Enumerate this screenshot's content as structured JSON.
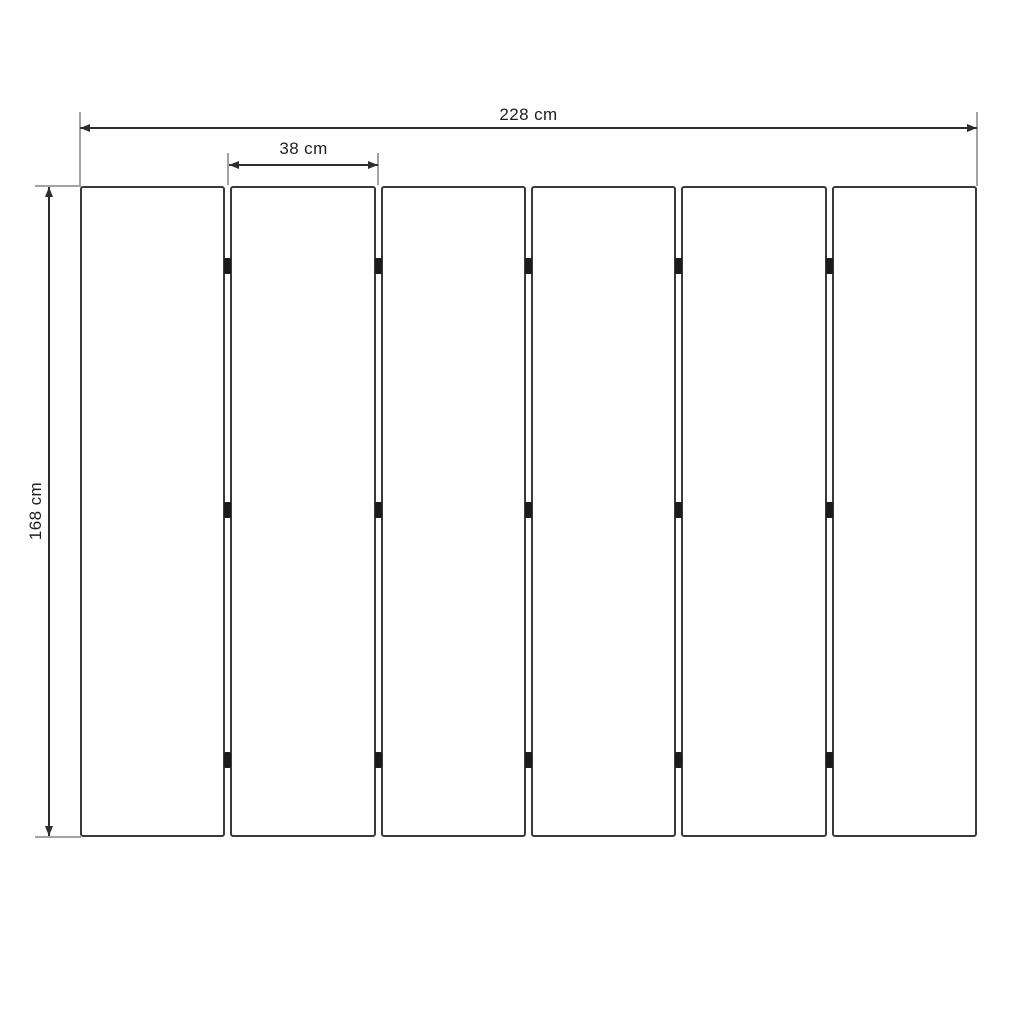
{
  "diagram": {
    "kind": "panel-wall-dimension-drawing",
    "colors": {
      "panel_border": "#3a3a3a",
      "dimension_line": "#2d2d2d",
      "extension_line": "#a3a3a3",
      "hinge": "#1b1b1b",
      "text": "#1f1f1f",
      "background": "#ffffff"
    },
    "panels": {
      "count": 6,
      "hinges_per_joint": 3,
      "hinge_y_offsets": [
        80,
        324,
        574
      ]
    },
    "dimensions": {
      "total_width": {
        "label": "228 cm",
        "value": 228,
        "unit": "cm"
      },
      "panel_width": {
        "label": "38 cm",
        "value": 38,
        "unit": "cm"
      },
      "height": {
        "label": "168 cm",
        "value": 168,
        "unit": "cm"
      }
    }
  }
}
